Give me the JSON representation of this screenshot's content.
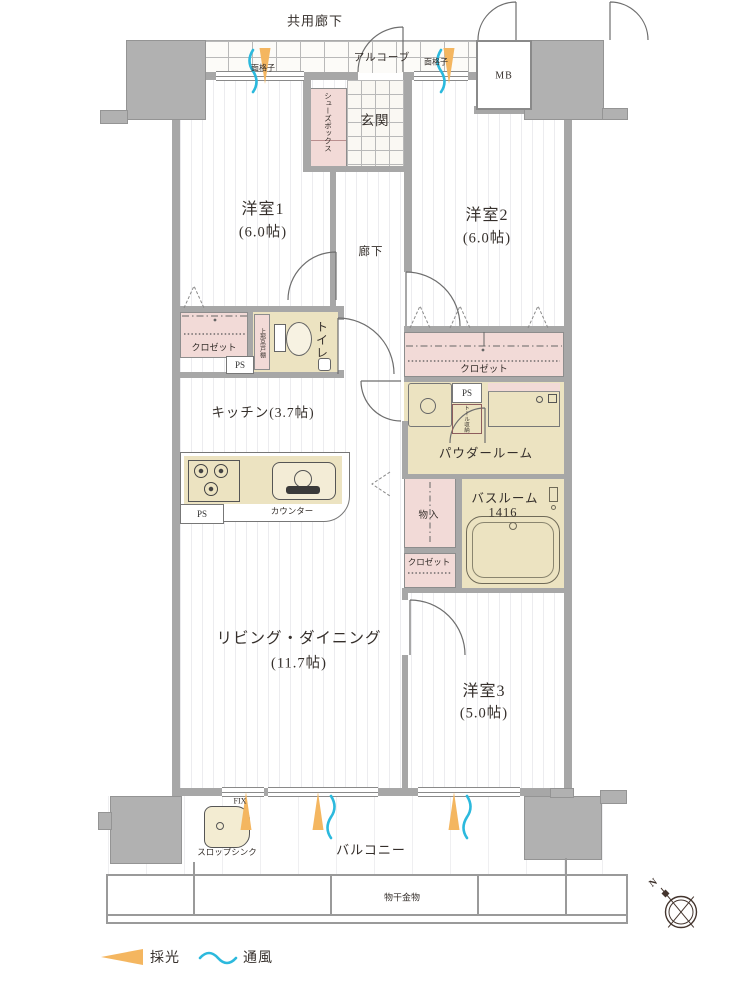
{
  "palette": {
    "wall": "#a7a7a7",
    "pink": "#f2dad7",
    "beige": "#ece3c1",
    "orange": "#f4b660",
    "blue": "#2cb9dd"
  },
  "top": {
    "common_corridor": "共用廊下",
    "alcove": "アルコーブ",
    "grille_left": "面格子",
    "grille_right": "面格子",
    "meter_box": "MB"
  },
  "entry": {
    "genkan": "玄関",
    "shoe_box": "シューズボックス"
  },
  "rooms": {
    "bedroom1_name": "洋室1",
    "bedroom1_size": "(6.0帖)",
    "bedroom2_name": "洋室2",
    "bedroom2_size": "(6.0帖)",
    "bedroom3_name": "洋室3",
    "bedroom3_size": "(5.0帖)",
    "living_name": "リビング・ダイニング",
    "living_size": "(11.7帖)",
    "kitchen_name": "キッチン(3.7帖)",
    "hallway": "廊下",
    "toilet": "トイレ",
    "powder_room": "パウダールーム",
    "bathroom_name": "バスルーム",
    "bathroom_size": "1416"
  },
  "storage": {
    "closet1": "クロゼット",
    "closet2": "クロゼット",
    "closet3": "クロゼット",
    "monoire": "物入",
    "upper_cabinet": "上部吊戸棚",
    "tall_storage": "トール収納"
  },
  "kitchen": {
    "counter": "カウンター"
  },
  "service": {
    "ps1": "PS",
    "ps2": "PS",
    "ps3": "PS",
    "fix": "FIX",
    "slop_sink": "スロップシンク"
  },
  "balcony": {
    "name": "バルコニー",
    "laundry_hanger": "物干金物"
  },
  "legend": {
    "daylight": "採光",
    "ventilation": "通風"
  },
  "compass": {
    "north": "N"
  }
}
